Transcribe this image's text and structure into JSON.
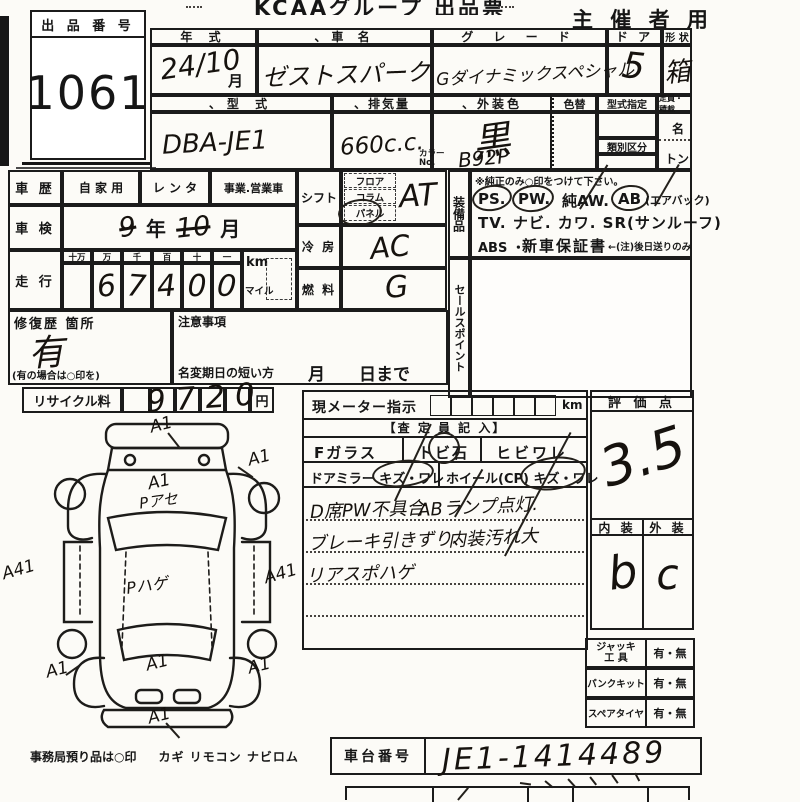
{
  "header": {
    "title": "KCAAグループ 出品票",
    "organizer": "主 催 者 用"
  },
  "lot": {
    "label": "出 品 番 号",
    "number": "1061"
  },
  "vehicle": {
    "year_label": "年   式",
    "year_value": "24/10",
    "year_unit": "月",
    "name_label": "、車    名",
    "name_value": "ゼストスパーク",
    "grade_label": "グ レ ー ド",
    "grade_value": "Gダイナミックスペシャル",
    "door_label": "ド ア",
    "door_value": "5",
    "shape_label": "形 状",
    "shape_value": "箱",
    "model_label": "、型    式",
    "model_value": "DBA-JE1",
    "disp_label": "、排気量",
    "disp_value": "660c.c.",
    "color_label": "、外装色",
    "color_value": "黒",
    "color_alt_label": "色替",
    "color_no_label": "カラーNo.",
    "color_no_value": "B92P",
    "type_desig_label": "型式指定",
    "class_label": "類別区分",
    "capacity_label": "定員・積載",
    "capacity_persons": "名",
    "capacity_tons": "トン"
  },
  "history": {
    "label": "車 歴",
    "opt1": "自 家 用",
    "opt2": "レ ン タ",
    "opt3": "事業.営業車",
    "inspection_label": "車 検",
    "inspection_struck_year": "9",
    "inspection_year_unit": "年",
    "inspection_struck_month": "10",
    "inspection_month_unit": "月",
    "mileage_label": "走 行",
    "digit_h1": "十万",
    "digit_h2": "万",
    "digit_h3": "千",
    "digit_h4": "百",
    "digit_h5": "十",
    "digit_h6": "一",
    "d1": "",
    "d2": "6",
    "d3": "7",
    "d4": "4",
    "d5": "0",
    "d6": "0",
    "unit_km": "km",
    "unit_mile": "マイル"
  },
  "drivetrain": {
    "shift_label": "シフト",
    "shift_opt1": "フロア",
    "shift_opt2": "コラム",
    "shift_opt3": "パネル",
    "shift_value": "AT",
    "cool_label": "冷 房",
    "cool_value": "AC",
    "fuel_label": "燃 料",
    "fuel_value": "G"
  },
  "equipment": {
    "label": "装備品",
    "note": "※純正のみ○印をつけて下さい。",
    "ps": "PS.",
    "pw": "PW.",
    "aw": "純AW.",
    "ab": "AB",
    "ab_note": "(エアバック)",
    "line2": "TV. ナビ. カワ. SR(サンルーフ)",
    "abs": "ABS ・",
    "warranty": "新車保証書",
    "warranty_note": "←(注)後日送りのみ"
  },
  "sales": {
    "label": "セールスポイント"
  },
  "repair": {
    "label": "修復歴 箇所",
    "value": "有",
    "note": "(有の場合は○印を)"
  },
  "caution": {
    "label": "注意事項",
    "name_change": "名変期日の短い方",
    "deadline": "月　　日まで"
  },
  "recycle": {
    "label": "リサイクル料",
    "value": "9720",
    "unit": "円"
  },
  "meter": {
    "label": "現メーター指示",
    "unit": "km",
    "appraiser": "【査 定 員 記 入】",
    "fglass": "Fガラス",
    "tobi": "トビ石",
    "hibi": "ヒビワレ",
    "mirror": "ドアミラー キズ・ワレ",
    "wheel": "ホイール(CP) キズ・ワレ",
    "note1a": "D席PW不具合",
    "note1b": "ABランプ点灯.",
    "note2a": "ブレーキ引きずり、",
    "note2b": "内装汚れ大",
    "note3": "リアスポハゲ"
  },
  "rating": {
    "label": "評 価 点",
    "value": "3.5",
    "interior_label": "内 装",
    "interior_value": "b",
    "exterior_label": "外 装",
    "exterior_value": "c"
  },
  "accessories": {
    "jack_label1": "ジャッキ",
    "jack_label2": "工  具",
    "jack_value": "有・無",
    "pank_label": "パンクキット",
    "pank_value": "有・無",
    "spare_label": "スペアタイヤ",
    "spare_value": "有・無"
  },
  "chassis": {
    "label": "車台番号",
    "value": "JE1-1414489"
  },
  "office": {
    "note": "事務局預り品は○印",
    "items": "カギ リモコン ナビロム"
  },
  "diagram": {
    "front": "A1",
    "right_fender": "A1",
    "hood1": "A1",
    "hood2": "Pアセ",
    "left_side": "A41",
    "right_side": "A41",
    "roof": "Pハゲ",
    "left_rear": "A1",
    "rear": "A1",
    "right_rear": "A1",
    "rear_bumper": "A1"
  }
}
